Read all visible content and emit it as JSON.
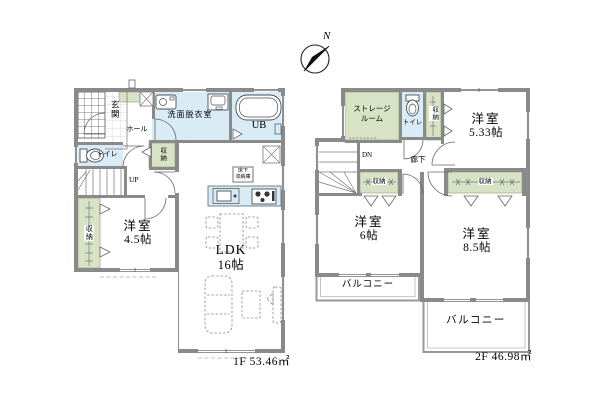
{
  "compass": {
    "north_label": "N"
  },
  "floor1": {
    "area_label": "1F 53.46㎡",
    "entrance_label": "玄関",
    "hall_label": "ホール",
    "washroom_label": "洗面脱衣室",
    "unit_bath_label": "UB",
    "toilet_label": "トイレ",
    "hall_closet_label": "収納",
    "stairs_label": "UP",
    "bedroom": {
      "name": "洋室",
      "size": "4.5帖"
    },
    "bedroom_closet_label": "収納",
    "ldk": {
      "name": "LDK",
      "size": "16帖"
    },
    "underfloor_storage": {
      "line1": "床下",
      "line2": "収納庫"
    }
  },
  "floor2": {
    "area_label": "2F 46.98㎡",
    "storage_room": {
      "line1": "ストレージ",
      "line2": "ルーム"
    },
    "toilet_label": "トイレ",
    "closet_right_label": "収納",
    "bedroom_533": {
      "name": "洋室",
      "size": "5.33帖"
    },
    "stairs_label": "DN",
    "corridor_label": "廊下",
    "closet_hall_label": "収納",
    "bedroom_6": {
      "name": "洋室",
      "size": "6帖"
    },
    "closet_main_label": "収納",
    "bedroom_85": {
      "name": "洋室",
      "size": "8.5帖"
    },
    "balcony_left_label": "バルコニー",
    "balcony_bottom_label": "バルコニー"
  },
  "colors": {
    "wall": "#8a8a8a",
    "wet": "#d9ebf5",
    "green": "#d8e3c6"
  }
}
